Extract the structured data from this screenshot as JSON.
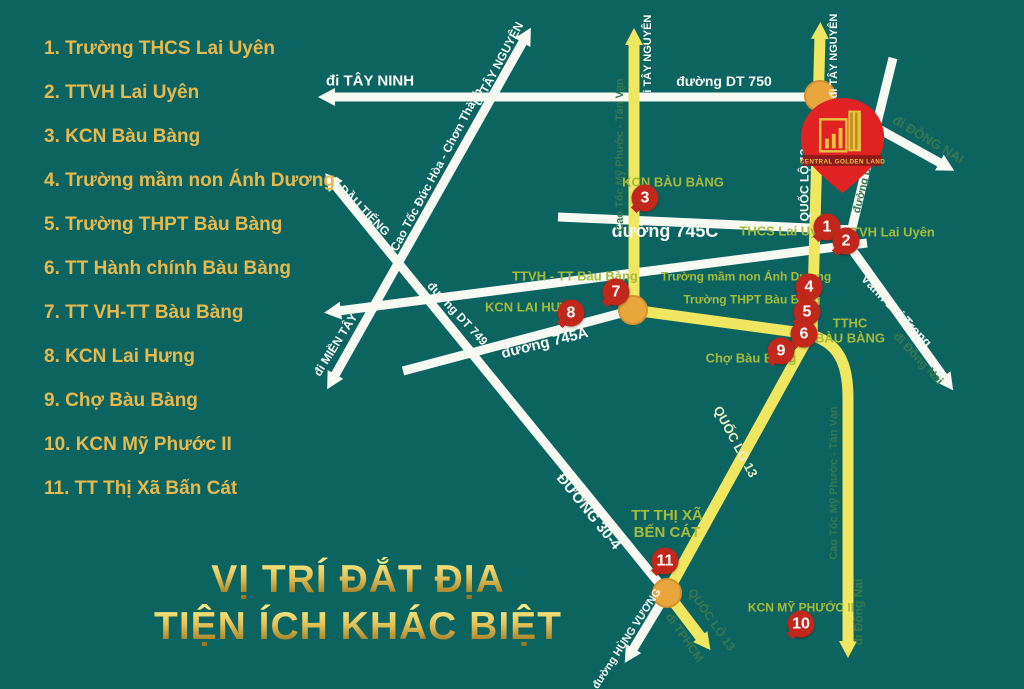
{
  "legend": {
    "items": [
      "1. Trường THCS Lai Uyên",
      "2. TTVH Lai Uyên",
      "3. KCN Bàu Bàng",
      "4. Trường mầm non Ánh Dương",
      "5. Trường THPT Bàu Bàng",
      "6. TT Hành chính Bàu Bàng",
      "7. TT VH-TT Bàu Bàng",
      "8. KCN Lai Hưng",
      "9. Chợ Bàu Bàng",
      "10. KCN Mỹ Phước II",
      "11. TT Thị Xã Bấn Cát"
    ]
  },
  "title": {
    "line1": "VỊ TRÍ ĐẮT ĐỊA",
    "line2": "TIỆN ÍCH KHÁC BIỆT"
  },
  "pin": {
    "brand": "CENTRAL GOLDEN LAND"
  },
  "map": {
    "roads": {
      "di_tay_ninh": "đi TÂY NINH",
      "duong_dt750": "đường DT 750",
      "di_tay_nguyen_nw": "đi TÂY NGUYÊN",
      "cao_toc_duc_hoa": "Cao Tốc Đức Hòa - Chơn Thành",
      "di_dau_tieng": "đi DẦU TIẾNG",
      "di_mien_tay": "đi MIỀN TÂY",
      "duong_dt749": "đường DT 749",
      "duong_745a": "đường 745A",
      "duong_745c": "đường 745C",
      "duong_304": "ĐƯỜNG 30-4",
      "duong_hung_vuong": "đường HÙNG VƯƠNG",
      "vanh_dai_trong": "Vành Đai Trong",
      "di_tay_nguyen_y1": "đi TÂY NGUYÊN",
      "di_tay_nguyen_y2": "đi TÂY NGUYÊN",
      "quoc_lo_13_y2": "QUỐC LỘ 13",
      "quoc_lo_13_mid": "QUỐC LỘ 13",
      "quoc_lo_13_s": "QUỐC LỘ 13",
      "di_tphcm": "đi TPHCM",
      "cao_toc_mpv_n": "Cao Tốc Mỹ Phước - Tân Vạn",
      "cao_toc_mpv_s": "Cao Tốc Mỹ Phước - Tân Vạn",
      "di_dong_nai_s": "đi Đồng Nai",
      "di_dong_nai_ne": "đi ĐỒNG NAI",
      "di_dong_nai_vdt": "đi Đồng Nai",
      "duong_dh516": "đường DH 516"
    },
    "places": {
      "kcn_bau_bang": "KCN BÀU BÀNG",
      "thcs_lai_uyen": "THCS Lai Uyên",
      "ttvh_lai_uyen": "TTVH Lai Uyên",
      "ttvh_tt_bau_bang": "TTVH - TT Bàu Bàng",
      "truong_mam_non": "Trường mầm non Ánh Dương",
      "truong_thpt": "Trường THPT Bàu Bàng",
      "kcn_lai_hung": "KCN LAI HƯNG",
      "tthc_bau_bang": "TTHC\nBÀU BÀNG",
      "cho_bau_bang": "Chợ Bàu Bàng",
      "tt_thi_xa_ben_cat": "TT THỊ XÃ\nBẾN CÁT",
      "kcn_my_phuoc_2": "KCN MỸ PHƯỚC II"
    },
    "markers": [
      "1",
      "2",
      "3",
      "4",
      "5",
      "6",
      "7",
      "8",
      "9",
      "10",
      "11"
    ]
  },
  "colors": {
    "background": "#0C6461",
    "legend_gold": "#E7B94C",
    "title_gold": "#D9B441",
    "place_label_green": "#A6BA3C",
    "roadside_label_green": "#37794F",
    "road_white": "#F7F9F3",
    "road_yellow": "#F0E65F",
    "node_orange": "#E8A63C",
    "marker_red": "#C1281B",
    "pin_red": "#E02222"
  }
}
